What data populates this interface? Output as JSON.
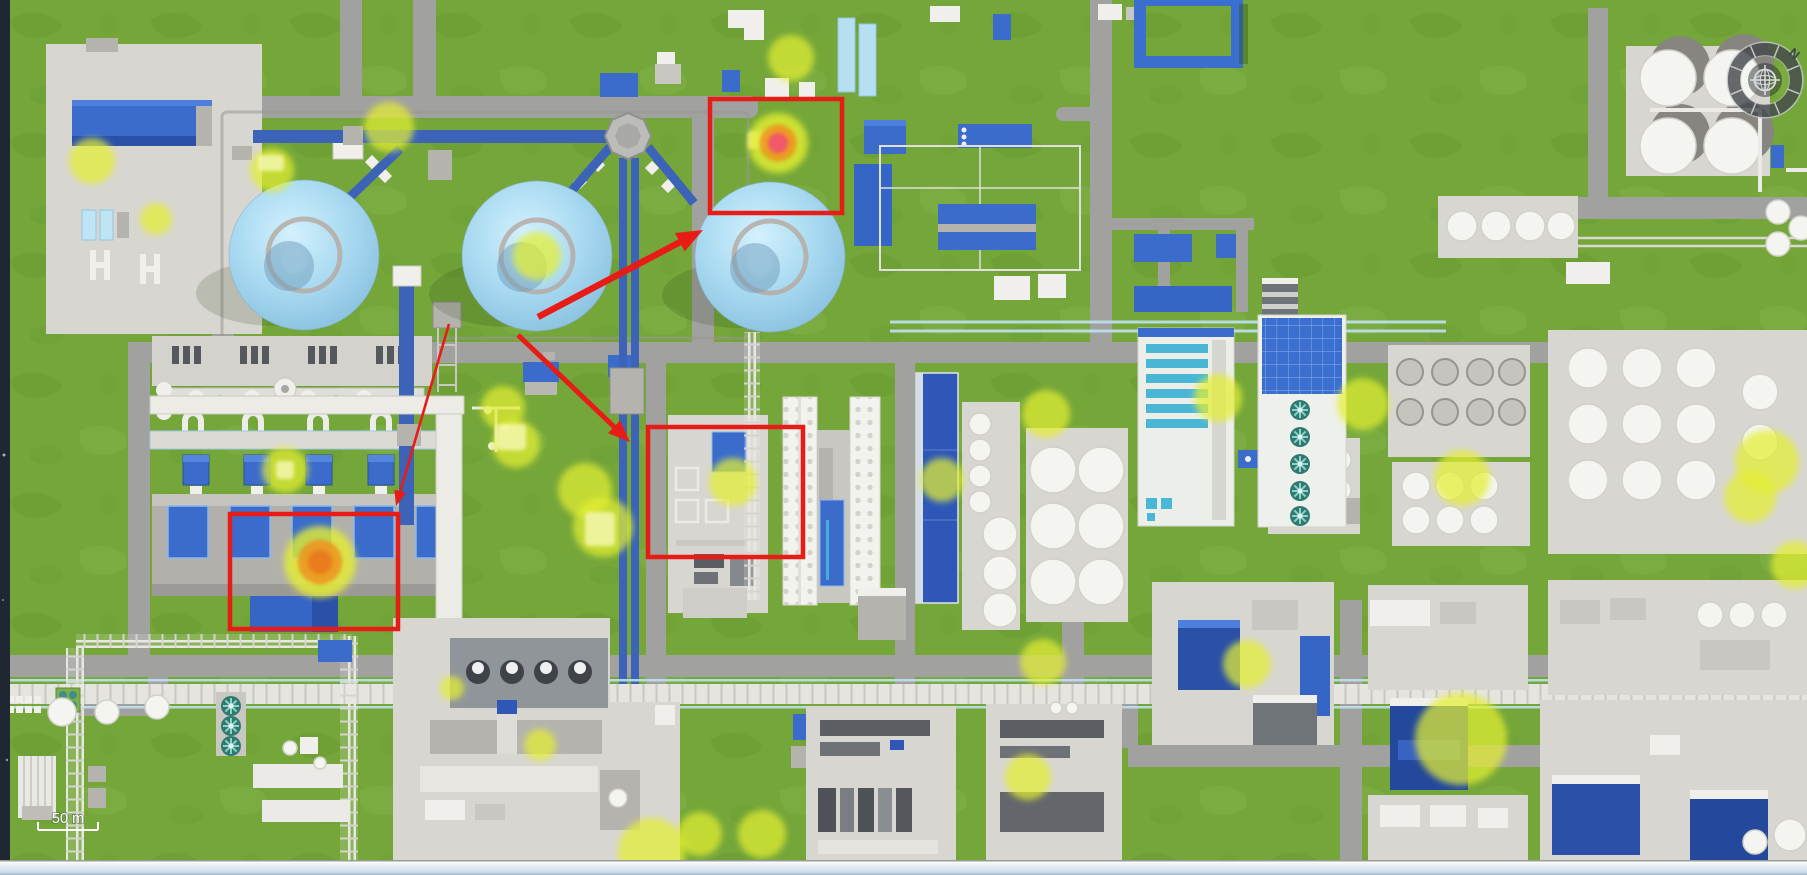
{
  "map": {
    "scale_bar": {
      "label": "50 m"
    },
    "compass": {
      "north_label": "N"
    },
    "colors": {
      "grass": "#74a63a",
      "road": "#a1a19f",
      "concrete": "#d8d6d1",
      "building_blue": "#3b6ccb",
      "sphere_blue": "#a9daf1",
      "pipe_blue": "#3c63b8",
      "highlight_yellow": "#e4ef33",
      "highlight_patch": "#f5f8ad",
      "alert_orange": "#ef8f1e",
      "alert_red": "#f2546c",
      "annotation_red": "#e81c17",
      "teal_panel": "#4ab6d6"
    },
    "annotations": {
      "rects": [
        {
          "x": 710,
          "y": 99,
          "w": 132,
          "h": 114
        },
        {
          "x": 230,
          "y": 514,
          "w": 168,
          "h": 115
        },
        {
          "x": 648,
          "y": 427,
          "w": 155,
          "h": 130
        }
      ],
      "arrows": [
        {
          "x1": 538,
          "y1": 317,
          "x2": 703,
          "y2": 230,
          "w": 6.5
        },
        {
          "x1": 518,
          "y1": 335,
          "x2": 630,
          "y2": 442,
          "w": 5
        },
        {
          "x1": 449,
          "y1": 324,
          "x2": 396,
          "y2": 506,
          "w": 2.6
        }
      ]
    },
    "markers": {
      "highlights": [
        {
          "x": 92,
          "y": 161,
          "r": 23
        },
        {
          "x": 156,
          "y": 219,
          "r": 16
        },
        {
          "x": 272,
          "y": 170,
          "r": 22
        },
        {
          "x": 389,
          "y": 127,
          "r": 25
        },
        {
          "x": 537,
          "y": 256,
          "r": 24
        },
        {
          "x": 791,
          "y": 58,
          "r": 23
        },
        {
          "x": 285,
          "y": 470,
          "r": 23
        },
        {
          "x": 503,
          "y": 408,
          "r": 22
        },
        {
          "x": 516,
          "y": 444,
          "r": 24
        },
        {
          "x": 585,
          "y": 490,
          "r": 27
        },
        {
          "x": 603,
          "y": 527,
          "r": 30
        },
        {
          "x": 733,
          "y": 482,
          "r": 24
        },
        {
          "x": 942,
          "y": 480,
          "r": 22
        },
        {
          "x": 1046,
          "y": 414,
          "r": 24
        },
        {
          "x": 1043,
          "y": 662,
          "r": 23
        },
        {
          "x": 1028,
          "y": 777,
          "r": 23
        },
        {
          "x": 652,
          "y": 852,
          "r": 34
        },
        {
          "x": 700,
          "y": 834,
          "r": 22
        },
        {
          "x": 762,
          "y": 834,
          "r": 24
        },
        {
          "x": 540,
          "y": 745,
          "r": 16
        },
        {
          "x": 452,
          "y": 688,
          "r": 12
        },
        {
          "x": 1247,
          "y": 664,
          "r": 24
        },
        {
          "x": 1461,
          "y": 739,
          "r": 46
        },
        {
          "x": 1363,
          "y": 404,
          "r": 26
        },
        {
          "x": 1218,
          "y": 398,
          "r": 24
        },
        {
          "x": 1462,
          "y": 478,
          "r": 28
        },
        {
          "x": 1767,
          "y": 462,
          "r": 32
        },
        {
          "x": 1750,
          "y": 497,
          "r": 26
        },
        {
          "x": 1795,
          "y": 565,
          "r": 24
        }
      ],
      "alerts": [
        {
          "x": 778,
          "y": 143,
          "r": 30,
          "core": "#f2546c"
        },
        {
          "x": 320,
          "y": 562,
          "r": 36,
          "core": "#ea7a1f"
        }
      ],
      "patches": [
        {
          "x": 258,
          "y": 155,
          "w": 26,
          "h": 16
        },
        {
          "x": 276,
          "y": 461,
          "w": 18,
          "h": 18
        },
        {
          "x": 496,
          "y": 424,
          "w": 30,
          "h": 26
        },
        {
          "x": 585,
          "y": 512,
          "w": 30,
          "h": 34
        },
        {
          "x": 748,
          "y": 131,
          "w": 34,
          "h": 18
        },
        {
          "x": 771,
          "y": 132,
          "w": 23,
          "h": 20,
          "fill": "#f2556e"
        }
      ]
    }
  }
}
